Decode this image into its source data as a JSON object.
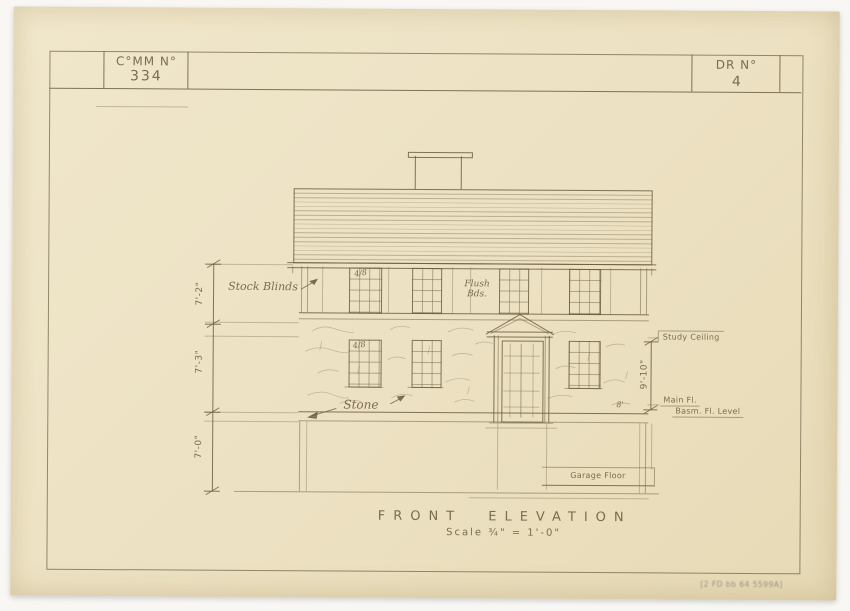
{
  "sheet": {
    "title_block": {
      "comm_label": "C°MM N°",
      "comm_value": "334",
      "dr_label": "DR N°",
      "dr_value": "4"
    },
    "title": "FRONT ELEVATION",
    "scale": "Scale ¾\" = 1'-0\"",
    "stamp": "[2 FD bb 64 5599A]"
  },
  "annotations": {
    "blinds": "Stock Blinds",
    "flush_line1": "Flush",
    "flush_line2": "Bds.",
    "stone": "Stone",
    "study_ceiling": "Study Ceiling",
    "main_floor": "Main Fl.",
    "basement_floor": "Basm. Fl. Level",
    "garage_floor": "Garage Floor",
    "window_mark_upper": "4/8",
    "window_mark_lower": "4/8",
    "door_mark": "8'"
  },
  "dimensions": {
    "second_floor_height": "7'-2\"",
    "first_floor_height": "7'-3\"",
    "basement_height": "7'-0\"",
    "ceiling_height": "9'-10\""
  },
  "colors": {
    "paper": "#ece1c2",
    "pencil": "#7d6c4e",
    "background": "#f8f7f4"
  }
}
